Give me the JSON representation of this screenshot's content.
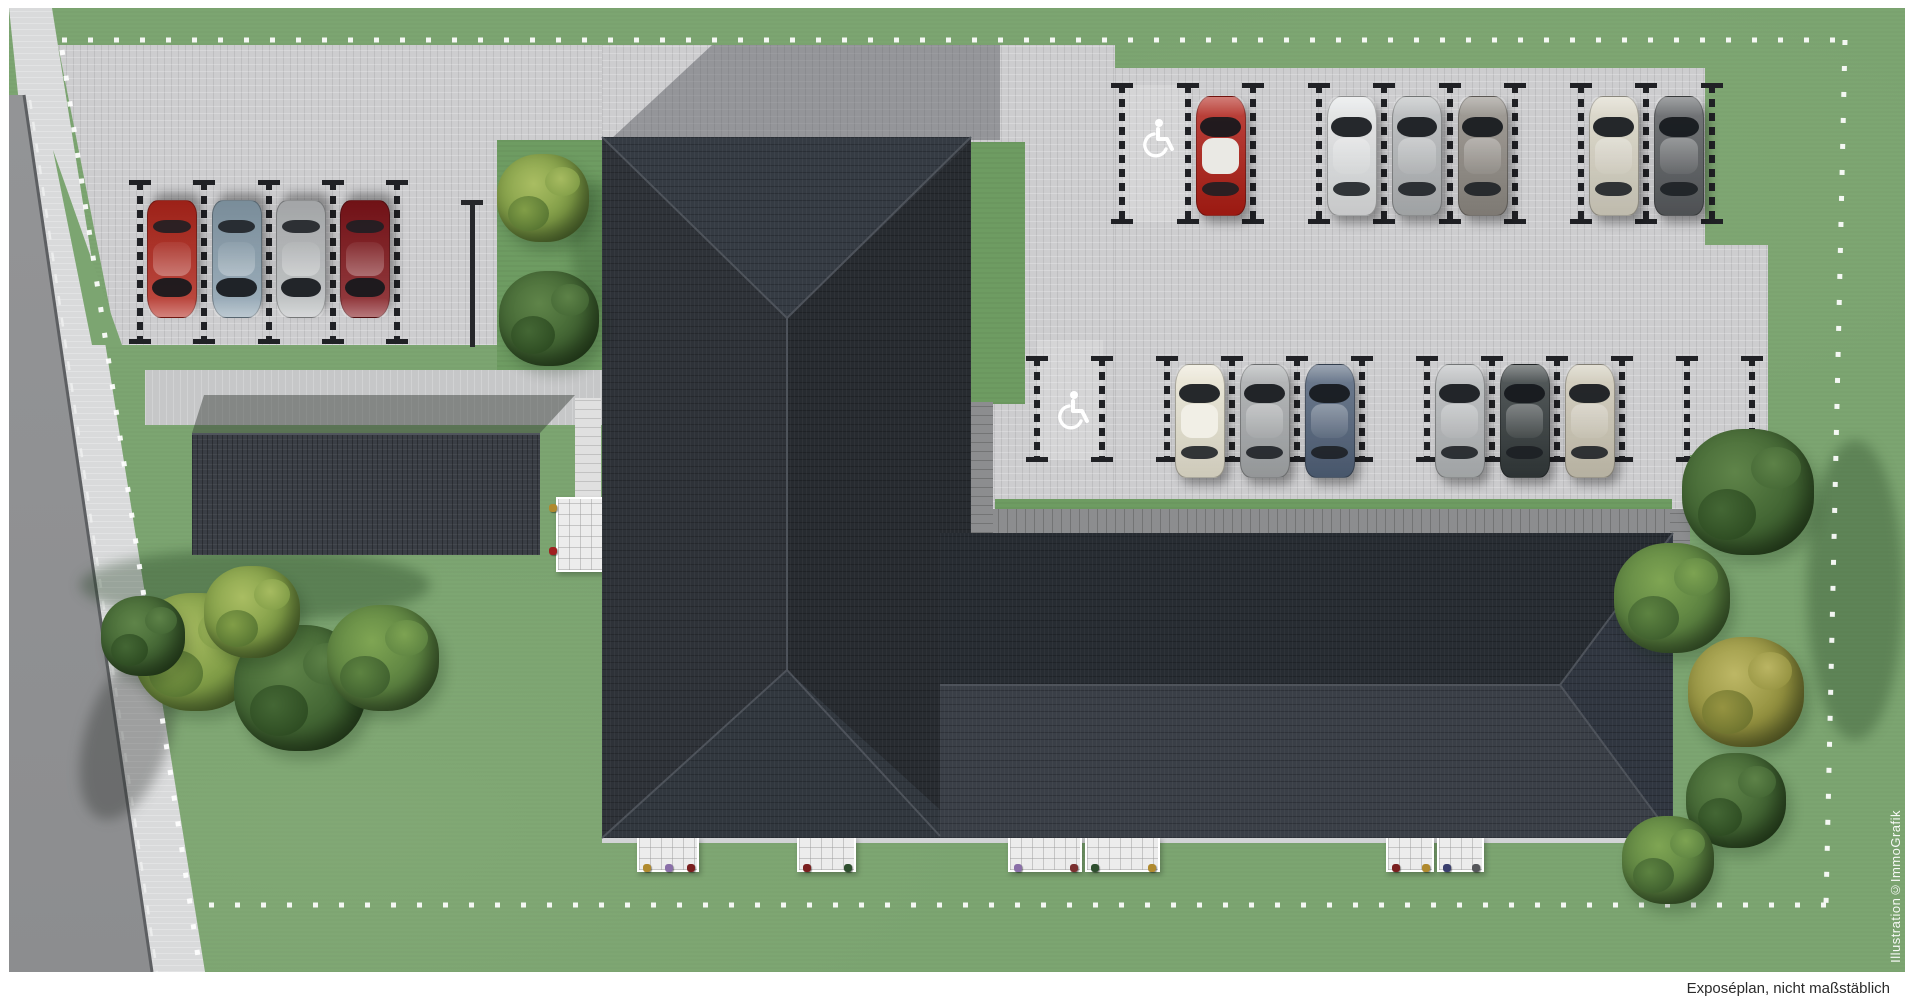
{
  "meta": {
    "caption": "Exposéplan, nicht maßstäblich",
    "watermark": "Illustration©ImmoGrafik"
  },
  "palette": {
    "grass": "#7ca571",
    "lawn_strip": "#6e9c62",
    "pavement": "#cdcdcf",
    "sidewalk": "#d9dadb",
    "road": "#909193",
    "roof_dark": "#272c32",
    "roof_light": "#3a3f47",
    "carport": "#3a3e45",
    "wall": "#8c8d8f",
    "terrace": "#ececec",
    "boundary_dots": "#ffffff",
    "accessible_icon": "#ffffff",
    "divider": "#202125"
  },
  "site": {
    "buildings": [
      {
        "id": "main-building-west-wing",
        "roof": "#2e3238"
      },
      {
        "id": "main-building-east-wing",
        "roof": "#3a3f47"
      },
      {
        "id": "carport",
        "roof": "#3a3e45"
      }
    ],
    "parking": {
      "west_row": {
        "name": "parking-row-west",
        "spaces": 4,
        "spots": [
          {
            "position": 1,
            "type": "car",
            "color": "#b2261b"
          },
          {
            "position": 2,
            "type": "car",
            "color": "#8aa0af"
          },
          {
            "position": 3,
            "type": "car",
            "color": "#b9bcbe"
          },
          {
            "position": 4,
            "type": "car",
            "color": "#801419"
          }
        ]
      },
      "north_row": {
        "name": "parking-row-north",
        "spaces": 9,
        "spots": [
          {
            "position": 1,
            "type": "accessible"
          },
          {
            "position": 2,
            "type": "car",
            "color": "#b01d14",
            "roof": "#eae9e4"
          },
          {
            "position": 3,
            "type": "empty"
          },
          {
            "position": 4,
            "type": "car",
            "color": "#e2e4e5"
          },
          {
            "position": 5,
            "type": "car",
            "color": "#b5b8ba"
          },
          {
            "position": 6,
            "type": "car",
            "color": "#8f8a83"
          },
          {
            "position": 7,
            "type": "empty"
          },
          {
            "position": 8,
            "type": "car",
            "color": "#d9d5c5"
          },
          {
            "position": 9,
            "type": "car",
            "color": "#595c5f"
          }
        ]
      },
      "south_row": {
        "name": "parking-row-south",
        "spaces": 11,
        "spots": [
          {
            "position": 1,
            "type": "accessible"
          },
          {
            "position": 2,
            "type": "empty"
          },
          {
            "position": 3,
            "type": "car",
            "color": "#eae6d4",
            "roof": "#f1efe6"
          },
          {
            "position": 4,
            "type": "car",
            "color": "#a8abad"
          },
          {
            "position": 5,
            "type": "car",
            "color": "#51627a"
          },
          {
            "position": 6,
            "type": "empty"
          },
          {
            "position": 7,
            "type": "car",
            "color": "#b6b9bb"
          },
          {
            "position": 8,
            "type": "car",
            "color": "#333a3b"
          },
          {
            "position": 9,
            "type": "car",
            "color": "#cfc9b7"
          },
          {
            "position": 10,
            "type": "empty"
          },
          {
            "position": 11,
            "type": "empty"
          }
        ]
      }
    },
    "terraces": {
      "south": [
        {
          "flowers": [
            "#b08a2e",
            "#8a6fa8",
            "#7a1f1f"
          ]
        },
        {
          "flowers": [
            "#7a1f1f",
            "#2f4f2f"
          ]
        },
        {
          "flowers": [
            "#8a6fa8",
            "#7a3030"
          ]
        },
        {
          "flowers": [
            "#2f4f2f",
            "#b08a2e"
          ]
        },
        {
          "flowers": [
            "#7a1f1f",
            "#b08a2e"
          ]
        },
        {
          "flowers": [
            "#3a3f6e",
            "#55565a"
          ]
        }
      ],
      "west": {
        "flowers": [
          "#b08a2e",
          "#a02020"
        ]
      }
    },
    "landscape": {
      "tree_groups": [
        {
          "location": "west-lawn",
          "count": 5
        },
        {
          "location": "strip-west-of-building",
          "count": 2
        },
        {
          "location": "east-lawn",
          "count": 5
        }
      ]
    }
  }
}
